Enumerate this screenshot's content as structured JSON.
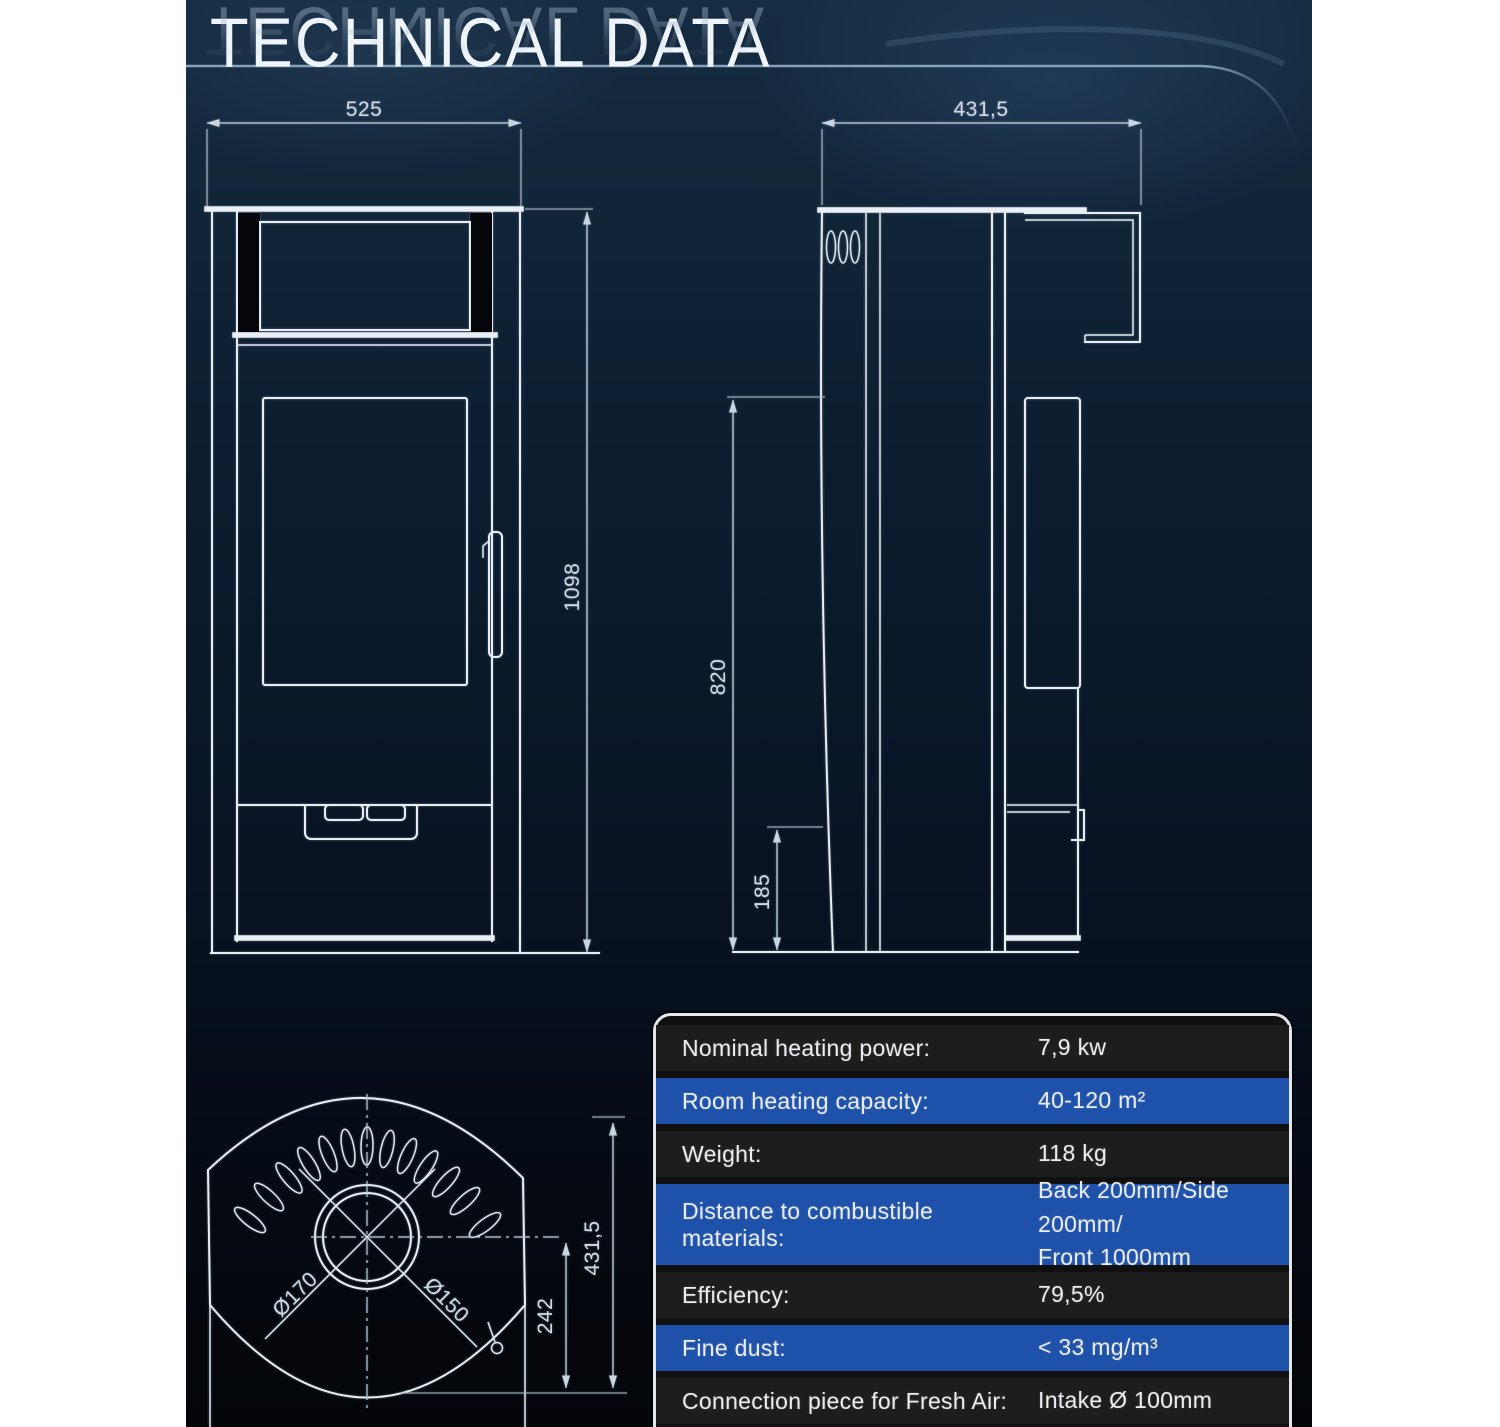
{
  "title": "TECHNICAL DATA",
  "colors": {
    "panel_top": "#162c42",
    "panel_bottom": "#030509",
    "accent_line": "#86a2ba",
    "drawing_line": "#e6edf3",
    "dimension_text": "#cfdae5",
    "table_blue": "#1e51a9",
    "table_dark": "#1d1d1d",
    "table_border": "#e3e6ea"
  },
  "front_view": {
    "width": "525",
    "height": "1098"
  },
  "side_view": {
    "depth": "431,5",
    "height": "820",
    "clearance": "185"
  },
  "top_view": {
    "outer_diameter": "Ø170",
    "inner_diameter": "Ø150",
    "offset": "242",
    "depth": "431,5"
  },
  "spec_table": {
    "rows": [
      {
        "label": "Nominal heating power:",
        "value": "7,9 kw"
      },
      {
        "label": "Room heating capacity:",
        "value": "40-120 m²"
      },
      {
        "label": "Weight:",
        "value": "118 kg"
      },
      {
        "label": "Distance to combustible materials:",
        "value": "Back 200mm/Side 200mm/",
        "value2": "Front 1000mm"
      },
      {
        "label": "Efficiency:",
        "value": "79,5%"
      },
      {
        "label": "Fine dust:",
        "value": "< 33 mg/m³"
      },
      {
        "label": "Connection piece for Fresh Air:",
        "value": "Intake Ø 100mm"
      }
    ]
  }
}
